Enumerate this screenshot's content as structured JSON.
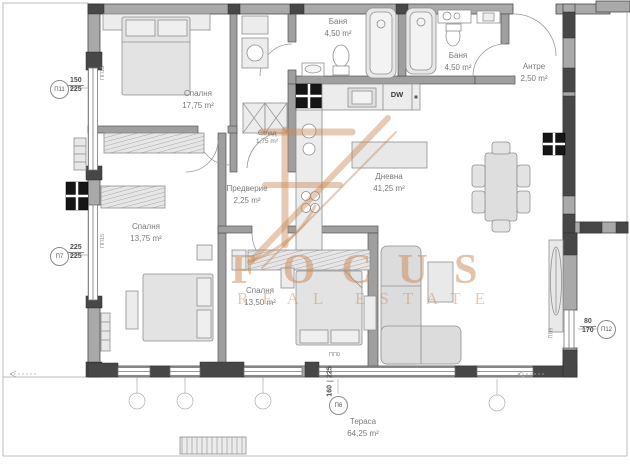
{
  "rooms": {
    "bedroom1": {
      "name": "Спалня",
      "area": "17,75 m²"
    },
    "bath1": {
      "name": "Баня",
      "area": "4,50 m²"
    },
    "bath2": {
      "name": "Баня",
      "area": "4,50 m²"
    },
    "antre": {
      "name": "Антре",
      "area": "2,50 m²"
    },
    "storage": {
      "name": "Склад",
      "area": "1,75 m²"
    },
    "hallway": {
      "name": "Предверие",
      "area": "2,25 m²"
    },
    "living": {
      "name": "Дневна",
      "area": "41,25 m²"
    },
    "bedroom2": {
      "name": "Спалня",
      "area": "13,75 m²"
    },
    "bedroom3": {
      "name": "Спалня",
      "area": "13,50 m²"
    },
    "terrace": {
      "name": "Тераса",
      "area": "64,25 m²"
    }
  },
  "markers": {
    "p11": {
      "id": "П11",
      "top": "150",
      "bottom": "225"
    },
    "p7": {
      "id": "П7",
      "top": "225",
      "bottom": "225"
    },
    "p6": {
      "id": "П6",
      "top": "160",
      "bottom": "225"
    },
    "p12": {
      "id": "П12",
      "top": "80",
      "bottom": "170"
    },
    "pp15_upper": "ПП15",
    "pp15_lower": "ПП15",
    "pp0": "ПП0",
    "pp9": "ПП9"
  },
  "kitchen": {
    "dishwasher": "DW"
  },
  "watermark": {
    "brand": "FOCUS",
    "tagline": "REAL ESTATE",
    "color": "#c98a57"
  },
  "colors": {
    "wall": "#a9a9a9",
    "wall_dark": "#474747",
    "furniture": "#e3e3e3"
  }
}
